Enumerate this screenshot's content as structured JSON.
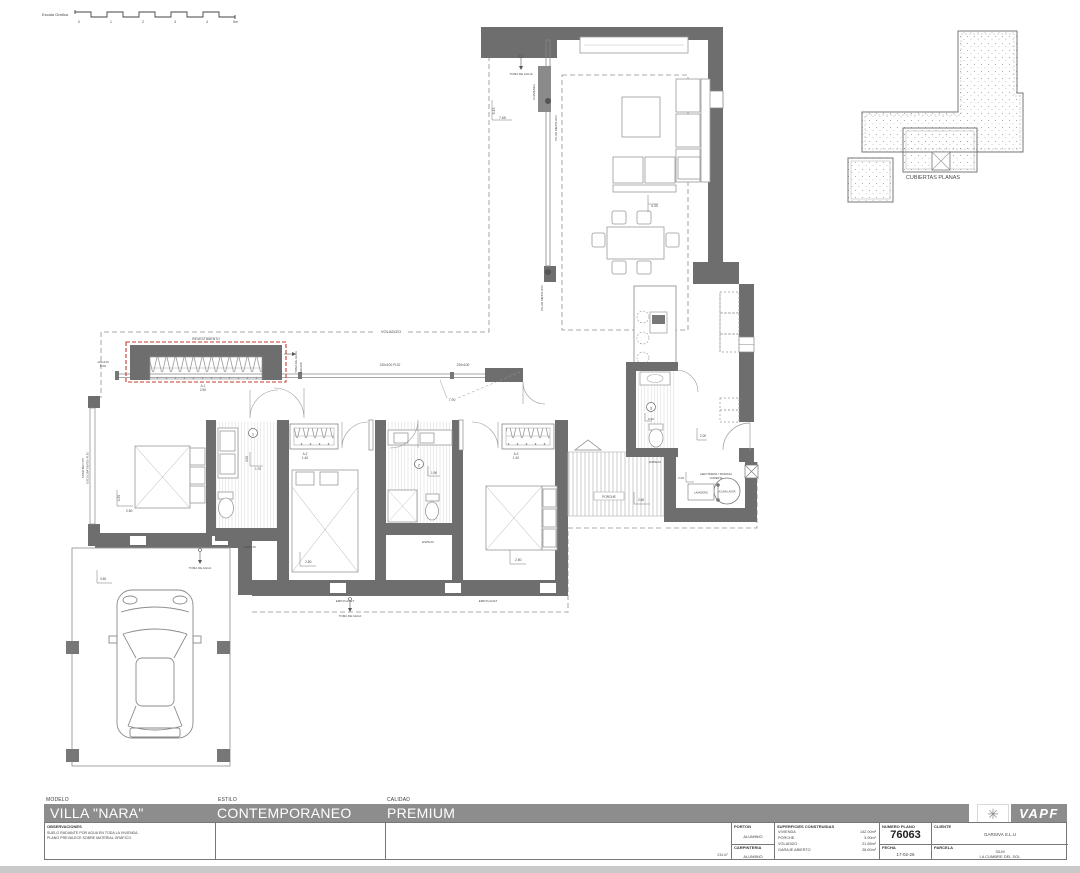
{
  "scale_bar": {
    "label": "Escala Gráfica",
    "ticks": [
      "0",
      "1",
      "2",
      "3",
      "4",
      "5m"
    ]
  },
  "roof_plan": {
    "label": "CUBIERTAS PLANAS"
  },
  "plan": {
    "labels": {
      "revestimiento": "REVESTIMIENTO",
      "toma_de_agua": "TOMA DE AGUA",
      "pilar_metalico": "PILAR METALICO",
      "chimenea": "CHIMENEA",
      "voladizo": "VOLADIZO",
      "porche": "PORCHE",
      "lavadero": "LAVADERO",
      "acumulador": "ACUMULADOR",
      "instal_1": "AEROTERMIA Y BIOMASA",
      "instal_2": "CUBIERTA",
      "espejo": "ESPEJO",
      "emplacet": "EMP.PLACET",
      "comp_met_1": "COMP.MET.175",
      "comp_met_2": "OSCILOBATIENTE+FIJO",
      "fijo_120": "120x210",
      "fijo_txt": "FIJO",
      "fijo_220": "220x100 FIJO",
      "v220": "220x100",
      "a1": "A.1",
      "a1_dim": "2.90",
      "a2": "A.2",
      "a2_dim": "1.40",
      "a3": "A.3",
      "a3_dim": "1.40",
      "n1": "1",
      "n2": "2",
      "n3": "3"
    },
    "dims": {
      "living_w": "7.65",
      "living_h": "6.45",
      "dining": "4.30",
      "pasillo": "7.90",
      "dorm1_l": "4.20",
      "dorm1_w": "2.80",
      "bano1_l": "3.00",
      "bano1_w": "1.70",
      "bano2": "1.90",
      "aseo": "0.90",
      "cocina": "2.00",
      "lavadero": "2.00",
      "porche": "2.60",
      "garaje": "3.60",
      "dorm2": "2.80",
      "dorm3": "2.80"
    }
  },
  "title_block": {
    "modelo_label": "MODELO",
    "modelo": "VILLA \"NARA\"",
    "estilo_label": "ESTILO",
    "estilo": "CONTEMPORANEO",
    "calidad_label": "CALIDAD",
    "calidad": "PREMIUM",
    "observaciones_label": "OBSERVACIONES",
    "observaciones_line1": "SUELO RADIANTE POR AGUA EN TODA LA VIVIENDA.",
    "observaciones_line2": "PLANO PREVALECE SOBRE MATERIAL GRÁFICO.",
    "sheet_ref": "234.67",
    "porton_label": "PORTON",
    "porton": "ALUMINIO",
    "carpinteria_label": "CARPINTERIA",
    "carpinteria": "ALUMINIO",
    "superficies_label": "SUPERFICIES CONSTRUIDAS",
    "superficies": [
      {
        "name": "VIVIENDA",
        "value": "142.00m²"
      },
      {
        "name": "PORCHE",
        "value": "3.90m²"
      },
      {
        "name": "VOLADIZO",
        "value": "21.65m²"
      },
      {
        "name": "GARAJE ABIERTO",
        "value": "26.60m²"
      }
    ],
    "numero_plano_label": "NUMERO PLANO",
    "numero_plano": "76063",
    "fecha_label": "FECHA",
    "fecha": "17-02-26",
    "cliente_label": "CLIENTE",
    "cliente": "GARSIVA S.L.U",
    "parcela_label": "PARCELA",
    "parcela_line1": "33-M",
    "parcela_line2": "LA CUMBRE DEL SOL",
    "logo": {
      "sun_icon": "✳",
      "text": "VAPF"
    }
  }
}
